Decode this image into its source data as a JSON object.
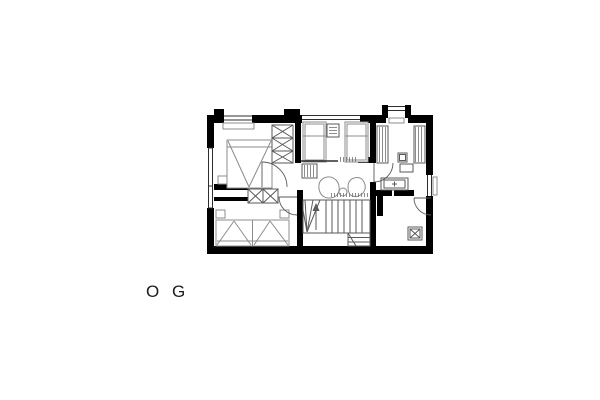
{
  "floor_label": {
    "text": "O G"
  },
  "plan": {
    "type": "architectural-floor-plan",
    "floor": "upper floor (OG)",
    "colors": {
      "background": "#ffffff",
      "wall": "#000000",
      "line": "#2e2e2e",
      "furniture": "#8c8c8c",
      "fixture": "#5a5a5a"
    }
  }
}
